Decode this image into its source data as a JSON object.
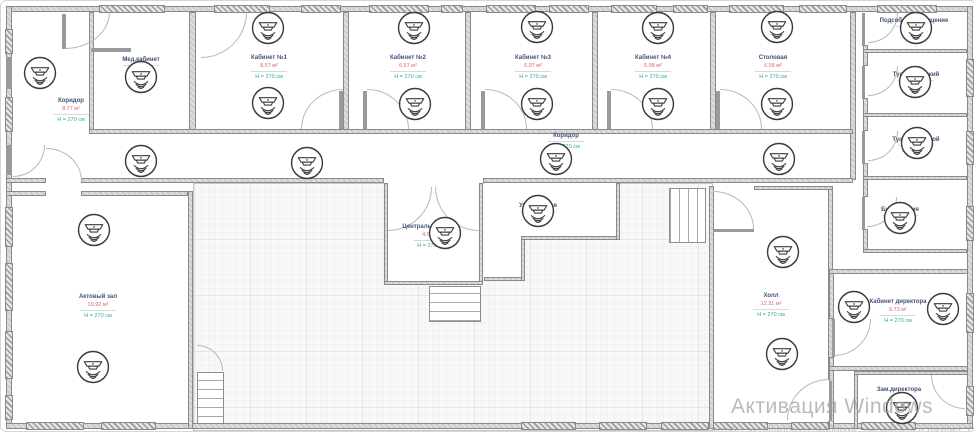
{
  "watermark": {
    "line1": "Активация Windows",
    "line2": "Чтобы активировать Windows, перейдите в раздел \"Параметры\"."
  },
  "rooms": [
    {
      "id": "koridor-left",
      "name": "Коридор",
      "area": "8.77 м²",
      "height": "H = 270 см",
      "cx": 70,
      "ty": 96
    },
    {
      "id": "med-kabinet",
      "name": "Мед.кабинет",
      "area": "",
      "height": "H = 270 см",
      "cx": 140,
      "ty": 55
    },
    {
      "id": "kabinet-1",
      "name": "Кабинет №1",
      "area": "8.57 м²",
      "height": "H = 270 см",
      "cx": 268,
      "ty": 53
    },
    {
      "id": "kabinet-2",
      "name": "Кабинет №2",
      "area": "6.57 м²",
      "height": "H = 270 см",
      "cx": 407,
      "ty": 53
    },
    {
      "id": "kabinet-3",
      "name": "Кабинет №3",
      "area": "6.97 м²",
      "height": "H = 270 см",
      "cx": 532,
      "ty": 53
    },
    {
      "id": "kabinet-4",
      "name": "Кабинет №4",
      "area": "5.98 м²",
      "height": "H = 270 см",
      "cx": 652,
      "ty": 53
    },
    {
      "id": "stolovaya",
      "name": "Столовая",
      "area": "6.58 м²",
      "height": "H = 270 см",
      "cx": 772,
      "ty": 53
    },
    {
      "id": "koridor-center",
      "name": "Коридор",
      "area": "",
      "height": "H = 270 см",
      "cx": 565,
      "ty": 131
    },
    {
      "id": "podsobnoe",
      "name": "Подсобное помещение",
      "area": "",
      "height": "H = 270 см",
      "cx": 913,
      "ty": 16
    },
    {
      "id": "tualet-zhenskiy",
      "name": "Туалет женский",
      "area": "",
      "height": "H = 270 см",
      "cx": 915,
      "ty": 70
    },
    {
      "id": "tualet-muzhskoy",
      "name": "Туалет мужской",
      "area": "",
      "height": "H = 270 см",
      "cx": 915,
      "ty": 135
    },
    {
      "id": "buhgalteriya",
      "name": "Бухгалтерия",
      "area": "",
      "height": "H = 270 см",
      "cx": 899,
      "ty": 205
    },
    {
      "id": "tsentralnyy-vhod",
      "name": "Центральный вход",
      "area": "4.07 м²",
      "height": "H = 270 см",
      "cx": 430,
      "ty": 222
    },
    {
      "id": "uchitelskaya",
      "name": "Учительская",
      "area": "",
      "height": "H = 270 см",
      "cx": 537,
      "ty": 201
    },
    {
      "id": "aktovyy-zal",
      "name": "Актовый зал",
      "area": "19.92 м²",
      "height": "H = 270 см",
      "cx": 97,
      "ty": 292
    },
    {
      "id": "holl",
      "name": "Холл",
      "area": "12.31 м²",
      "height": "H = 270 см",
      "cx": 770,
      "ty": 291
    },
    {
      "id": "kabinet-direktora",
      "name": "Кабинет директора",
      "area": "6.73 м²",
      "height": "H = 270 см",
      "cx": 897,
      "ty": 297
    },
    {
      "id": "zam-direktora",
      "name": "Зам.директора",
      "area": "",
      "height": "",
      "cx": 898,
      "ty": 385
    }
  ],
  "detectors": [
    {
      "x": 39,
      "y": 72
    },
    {
      "x": 140,
      "y": 76
    },
    {
      "x": 267,
      "y": 27
    },
    {
      "x": 267,
      "y": 102
    },
    {
      "x": 413,
      "y": 27
    },
    {
      "x": 414,
      "y": 103
    },
    {
      "x": 536,
      "y": 26
    },
    {
      "x": 536,
      "y": 103
    },
    {
      "x": 657,
      "y": 27
    },
    {
      "x": 657,
      "y": 103
    },
    {
      "x": 776,
      "y": 26
    },
    {
      "x": 776,
      "y": 103
    },
    {
      "x": 140,
      "y": 160
    },
    {
      "x": 306,
      "y": 162
    },
    {
      "x": 555,
      "y": 158
    },
    {
      "x": 778,
      "y": 158
    },
    {
      "x": 915,
      "y": 27
    },
    {
      "x": 914,
      "y": 81
    },
    {
      "x": 916,
      "y": 142
    },
    {
      "x": 899,
      "y": 217
    },
    {
      "x": 444,
      "y": 232
    },
    {
      "x": 537,
      "y": 210
    },
    {
      "x": 93,
      "y": 229
    },
    {
      "x": 92,
      "y": 366
    },
    {
      "x": 782,
      "y": 251
    },
    {
      "x": 781,
      "y": 353
    },
    {
      "x": 853,
      "y": 306
    },
    {
      "x": 942,
      "y": 308
    },
    {
      "x": 901,
      "y": 407
    }
  ],
  "colors": {
    "room_name": "#44517c",
    "room_area": "#e0607c",
    "room_height": "#2ea9a4",
    "wall_fill": "#cfcfcf",
    "wall_stroke": "#8a8a8a",
    "detector_stroke": "#3c3c3c",
    "detector_dot": "#4aa96c",
    "watermark": "#a3a3a3"
  }
}
